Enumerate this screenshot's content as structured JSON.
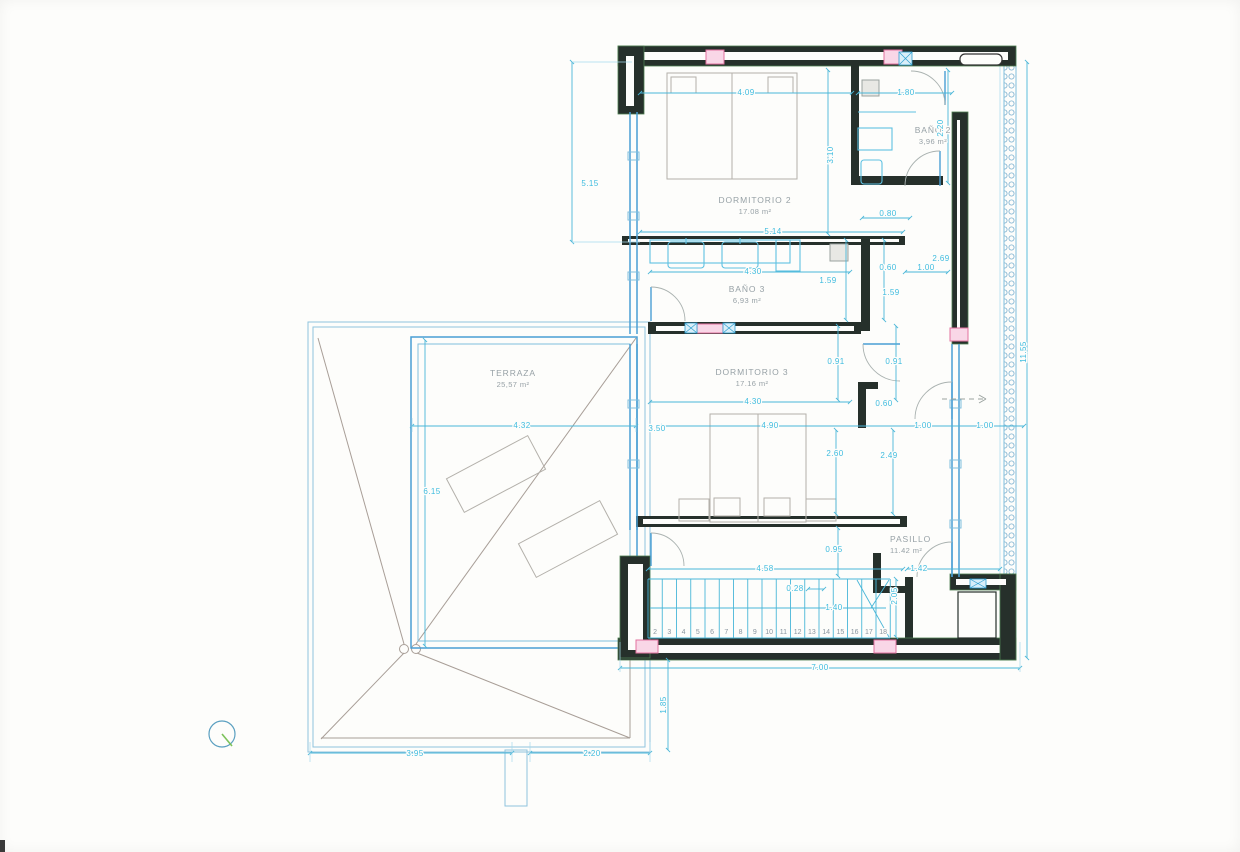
{
  "drawing": {
    "type": "architectural-floor-plan",
    "rooms": [
      {
        "name": "DORMITORIO 2",
        "area": "17.08 m²",
        "x": 755,
        "y": 203,
        "anchor": "middle"
      },
      {
        "name": "BAÑO 2",
        "area": "3,96 m²",
        "x": 933,
        "y": 133,
        "anchor": "middle"
      },
      {
        "name": "BAÑO 3",
        "area": "6,93 m²",
        "x": 747,
        "y": 292,
        "anchor": "middle"
      },
      {
        "name": "DORMITORIO 3",
        "area": "17.16 m²",
        "x": 752,
        "y": 375,
        "anchor": "middle"
      },
      {
        "name": "TERRAZA",
        "area": "25,57 m²",
        "x": 513,
        "y": 376,
        "anchor": "middle"
      },
      {
        "name": "PASILLO",
        "area": "11.42 m²",
        "x": 890,
        "y": 542,
        "anchor": "start"
      }
    ],
    "dimensions": [
      {
        "t": "5.15",
        "x": 590,
        "y": 186
      },
      {
        "t": "4.09",
        "x": 746,
        "y": 95
      },
      {
        "t": "1.80",
        "x": 906,
        "y": 95
      },
      {
        "t": "2.20",
        "x": 943,
        "y": 128,
        "r": -90
      },
      {
        "t": "3.10",
        "x": 833,
        "y": 155,
        "r": -90
      },
      {
        "t": "0.80",
        "x": 888,
        "y": 216
      },
      {
        "t": "5.14",
        "x": 773,
        "y": 234
      },
      {
        "t": "4.30",
        "x": 753,
        "y": 274
      },
      {
        "t": "1.59",
        "x": 828,
        "y": 283
      },
      {
        "t": "0.60",
        "x": 888,
        "y": 270
      },
      {
        "t": "1.00",
        "x": 926,
        "y": 270
      },
      {
        "t": "2.69",
        "x": 941,
        "y": 261
      },
      {
        "t": "1.59",
        "x": 891,
        "y": 295
      },
      {
        "t": "0.91",
        "x": 836,
        "y": 364
      },
      {
        "t": "0.91",
        "x": 894,
        "y": 364
      },
      {
        "t": "11.55",
        "x": 1026,
        "y": 352,
        "r": -90
      },
      {
        "t": "4.30",
        "x": 753,
        "y": 404
      },
      {
        "t": "0.60",
        "x": 884,
        "y": 406
      },
      {
        "t": "4.32",
        "x": 522,
        "y": 428
      },
      {
        "t": "3.50",
        "x": 657,
        "y": 431
      },
      {
        "t": "4.90",
        "x": 770,
        "y": 428
      },
      {
        "t": "1.00",
        "x": 923,
        "y": 428
      },
      {
        "t": "1.00",
        "x": 985,
        "y": 428
      },
      {
        "t": "2.60",
        "x": 835,
        "y": 456
      },
      {
        "t": "2.49",
        "x": 889,
        "y": 458
      },
      {
        "t": "6.15",
        "x": 432,
        "y": 494
      },
      {
        "t": "0.95",
        "x": 834,
        "y": 552
      },
      {
        "t": "4.58",
        "x": 765,
        "y": 571
      },
      {
        "t": "1.42",
        "x": 919,
        "y": 571
      },
      {
        "t": "0.28",
        "x": 795,
        "y": 591
      },
      {
        "t": "2.05",
        "x": 897,
        "y": 596,
        "r": -90
      },
      {
        "t": "1.40",
        "x": 834,
        "y": 610
      },
      {
        "t": "7.00",
        "x": 820,
        "y": 670
      },
      {
        "t": "1.85",
        "x": 666,
        "y": 705,
        "r": -90
      },
      {
        "t": "3.95",
        "x": 415,
        "y": 756
      },
      {
        "t": "2.20",
        "x": 592,
        "y": 756
      }
    ],
    "stairs": {
      "numbers": [
        "2",
        "3",
        "4",
        "5",
        "6",
        "7",
        "8",
        "9",
        "10",
        "11",
        "12",
        "13",
        "14",
        "15",
        "16",
        "17",
        "18"
      ],
      "x_start": 648,
      "step": 14.25,
      "y": 634
    },
    "colors": {
      "wall": "#26302b",
      "wall_edge_green": "#4d7d50",
      "window_blue": "#4a9fd4",
      "dimension_cyan": "#3fbcdf",
      "label_gray": "#97a1a6",
      "column_pink": "#e2729f",
      "roof_gray": "#a89e97",
      "north_green": "#7cc25a"
    }
  }
}
